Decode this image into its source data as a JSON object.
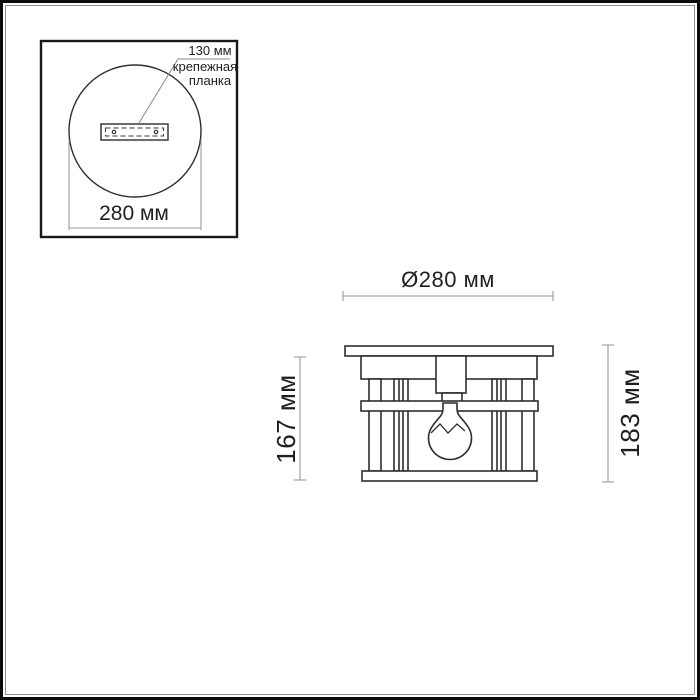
{
  "labels": {
    "inset": {
      "bracket_size": "130 мм",
      "bracket_name_line1": "крепежная",
      "bracket_name_line2": "планка",
      "diameter": "280 мм"
    },
    "main": {
      "diameter": "Ø280 мм",
      "height_body": "167 мм",
      "height_total": "183 мм"
    }
  },
  "colors": {
    "outline": "#2e2e2e",
    "dimension_line": "#9a9a9a",
    "frame": "#0b0b0b",
    "text": "#1f1f1f"
  }
}
